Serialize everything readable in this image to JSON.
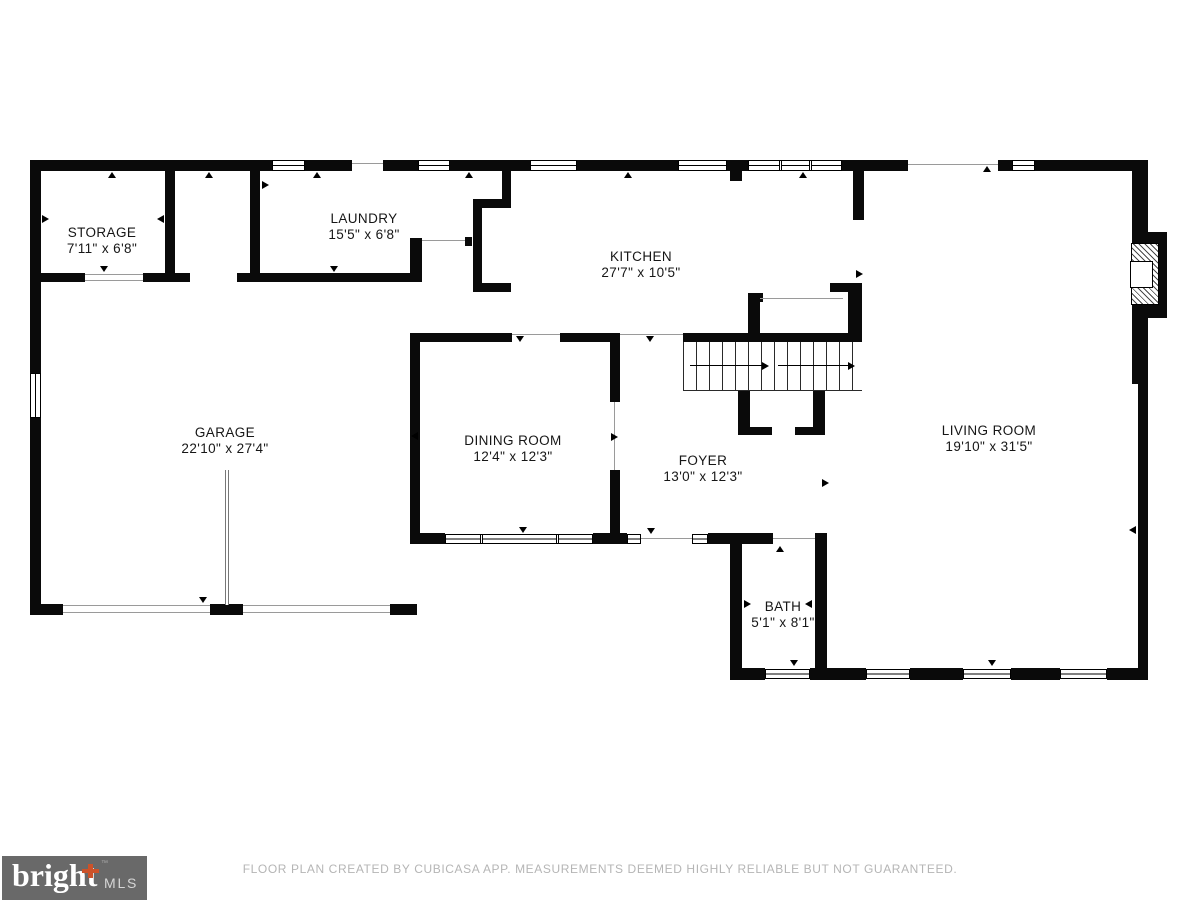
{
  "meta": {
    "footer": "FLOOR PLAN CREATED BY CUBICASA APP. MEASUREMENTS DEEMED HIGHLY RELIABLE BUT NOT GUARANTEED."
  },
  "logo": {
    "brand": "bright",
    "tm": "™",
    "suffix": "MLS",
    "bg": "#696969",
    "accent": "#cc5229"
  },
  "colors": {
    "wall": "#0a0a0a",
    "footer_text": "#b5b5b5",
    "logo_bg": "#696969",
    "logo_accent": "#cc5229"
  },
  "rooms": [
    {
      "id": "storage",
      "name": "STORAGE",
      "dims": "7'11\" x 6'8\""
    },
    {
      "id": "laundry",
      "name": "LAUNDRY",
      "dims": "15'5\" x 6'8\""
    },
    {
      "id": "kitchen",
      "name": "KITCHEN",
      "dims": "27'7\" x 10'5\""
    },
    {
      "id": "garage",
      "name": "GARAGE",
      "dims": "22'10\" x 27'4\""
    },
    {
      "id": "dining",
      "name": "DINING ROOM",
      "dims": "12'4\" x 12'3\""
    },
    {
      "id": "foyer",
      "name": "FOYER",
      "dims": "13'0\" x 12'3\""
    },
    {
      "id": "living",
      "name": "LIVING ROOM",
      "dims": "19'10\" x 31'5\""
    },
    {
      "id": "bath",
      "name": "BATH",
      "dims": "5'1\" x 8'1\""
    }
  ]
}
